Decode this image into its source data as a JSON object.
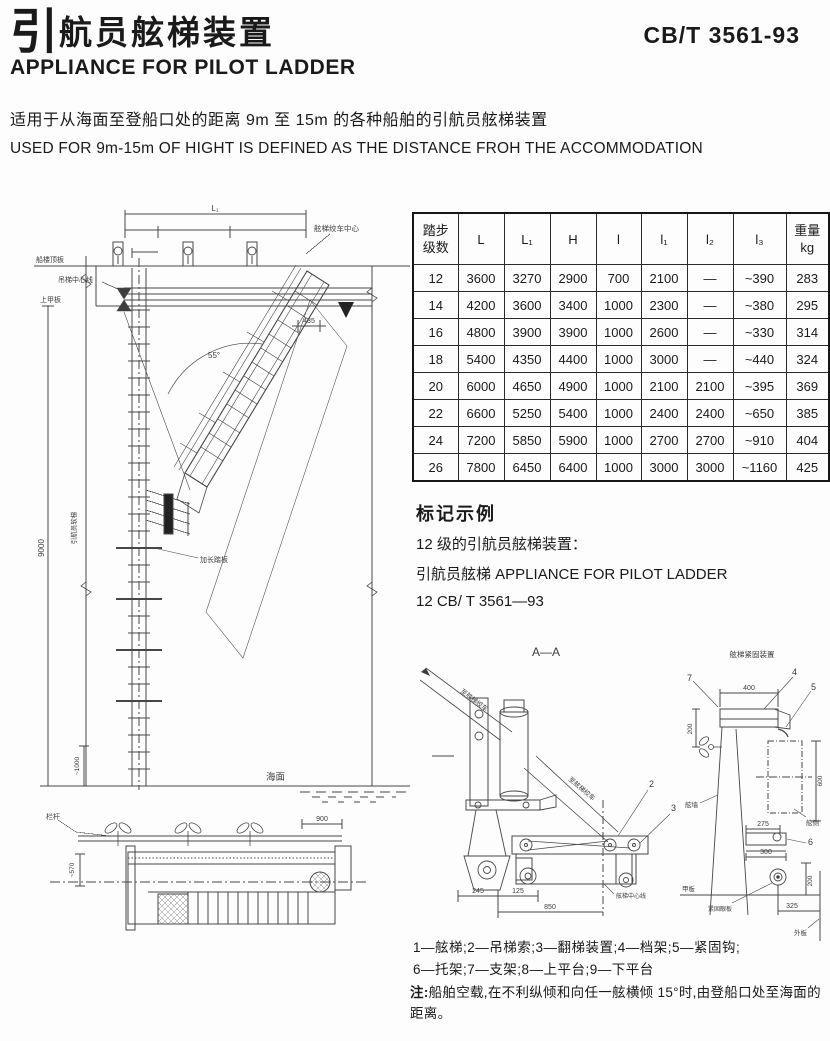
{
  "colors": {
    "ink": "#1a1a1a",
    "line": "#3f3f3f",
    "paper": "#fdfdfd"
  },
  "header": {
    "title_zh_first": "引",
    "title_zh_rest": "航员舷梯装置",
    "standard_no": "CB/T 3561-93",
    "title_en": "APPLIANCE FOR PILOT LADDER"
  },
  "intro": {
    "line_zh": "适用于从海面至登船口处的距离 9m 至 15m 的各种船舶的引航员舷梯装置",
    "line_en": "USED FOR 9m-15m OF HIGHT IS DEFINED AS THE DISTANCE FROH THE ACCOMMODATION"
  },
  "table": {
    "header": {
      "steps1": "踏步",
      "steps2": "级数",
      "L": "L",
      "L1": "L₁",
      "H": "H",
      "l": "l",
      "l1": "l₁",
      "l2": "l₂",
      "l3": "l₃",
      "w1": "重量",
      "w2": "kg"
    },
    "rows": [
      [
        "12",
        "3600",
        "3270",
        "2900",
        "700",
        "2100",
        "—",
        "~390",
        "283"
      ],
      [
        "14",
        "4200",
        "3600",
        "3400",
        "1000",
        "2300",
        "—",
        "~380",
        "295"
      ],
      [
        "16",
        "4800",
        "3900",
        "3900",
        "1000",
        "2600",
        "—",
        "~330",
        "314"
      ],
      [
        "18",
        "5400",
        "4350",
        "4400",
        "1000",
        "3000",
        "—",
        "~440",
        "324"
      ],
      [
        "20",
        "6000",
        "4650",
        "4900",
        "1000",
        "2100",
        "2100",
        "~395",
        "369"
      ],
      [
        "22",
        "6600",
        "5250",
        "5400",
        "1000",
        "2400",
        "2400",
        "~650",
        "385"
      ],
      [
        "24",
        "7200",
        "5850",
        "5900",
        "1000",
        "2700",
        "2700",
        "~910",
        "404"
      ],
      [
        "26",
        "7800",
        "6450",
        "6400",
        "1000",
        "3000",
        "3000",
        "~1160",
        "425"
      ]
    ]
  },
  "marking": {
    "heading": "标记示例",
    "line1": "12 级的引航员舷梯装置：",
    "line2": "引航员舷梯 APPLIANCE FOR PILOT LADDER",
    "line3": "12 CB/ T 3561—93"
  },
  "drawings": {
    "main": {
      "dim_L1": "L₁",
      "label_winch_center": "舷梯绞车中心",
      "label_top_deck": "船楼顶板",
      "label_upper_deck": "上甲板",
      "label_hoist_centerline": "吊梯中心线",
      "angle_55": "55°",
      "dim_435": "435",
      "dim_9000": "9000",
      "label_pilot_rope": "引航员软梯",
      "label_spreader_step": "加长踏板",
      "label_sea": "海面",
      "dim_1000": "~1000"
    },
    "plan": {
      "label_rail": "栏杆",
      "dim_900": "900",
      "dim_570": "~570"
    },
    "aa": {
      "title": "A—A",
      "label_to_winch_1": "至舷梯绞车",
      "label_to_winch_2": "至舷梯绞车",
      "callout_2": "2",
      "callout_3": "3",
      "dim_245": "245",
      "dim_125": "125",
      "dim_850": "850",
      "label_ladder_centerline": "舷梯中心线"
    },
    "securing": {
      "title": "舷梯紧固装置",
      "callout_7": "7",
      "callout_4": "4",
      "callout_5": "5",
      "callout_6": "6",
      "dim_400": "400",
      "dim_200_left": "200",
      "dim_600": "600",
      "dim_275": "275",
      "dim_300": "300",
      "dim_200_right": "200",
      "dim_325": "325",
      "label_bulwark": "舷墙",
      "label_side": "舷侧",
      "label_deck": "甲板",
      "label_eye_plate": "紧固眼板",
      "label_shell": "外板"
    }
  },
  "legend": {
    "line1": "1—舷梯;2—吊梯索;3—翻梯装置;4—档架;5—紧固钩;",
    "line2": "6—托架;7—支架;8—上平台;9—下平台"
  },
  "note": {
    "prefix": "注:",
    "text": "船舶空载,在不利纵倾和向任一舷横倾 15°时,由登船口处至海面的距离。"
  }
}
